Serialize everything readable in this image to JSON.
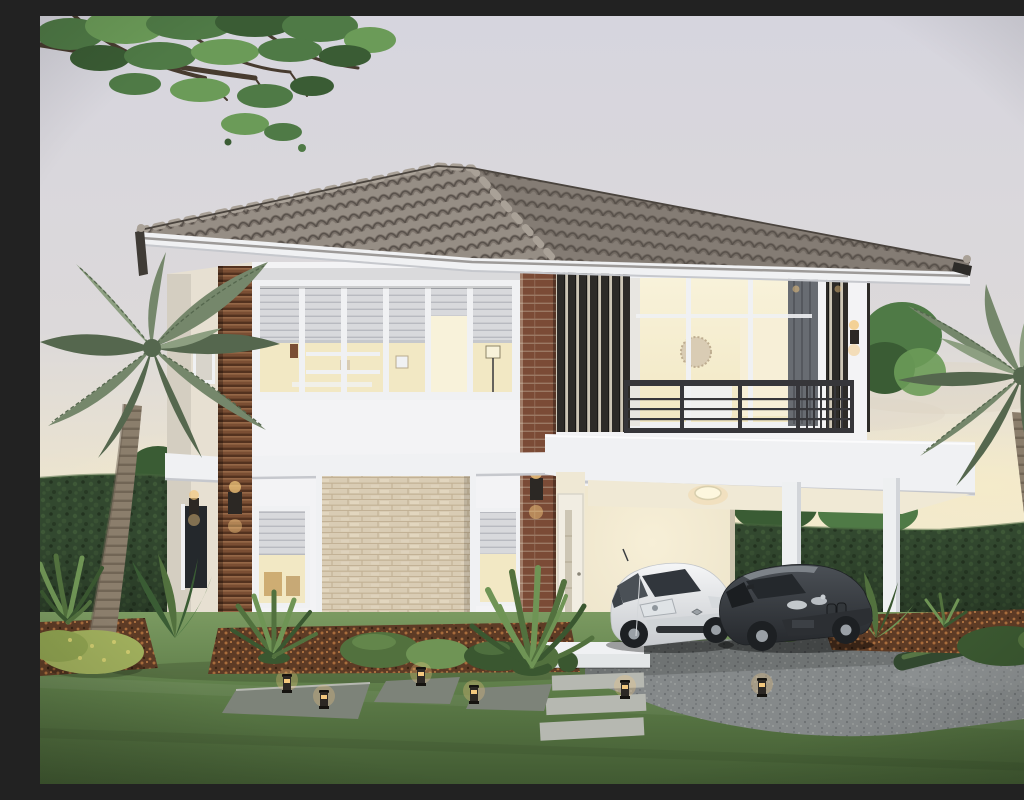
{
  "scene": {
    "label": "Architectural rendering of a two-story modern house at dusk with gray tile hip roof, wood-slat accents, lit interiors, balcony, carport with a white hatchback and a dark sedan, palm trees, perimeter hedge, lawn with stepping stones and garden bollard lights",
    "type": "exterior-architectural-rendering",
    "time_of_day": "dusk",
    "house": {
      "stories": 2,
      "roof": "gray-tile-hip-roof",
      "features": [
        "wrap-around-white-slab-band",
        "balcony-with-dark-railing",
        "vertical-louver-screens",
        "wood-slat-columns",
        "stone-feature-wall",
        "carport",
        "warm-interior-lighting",
        "wall-sconces",
        "roller-blinds"
      ]
    },
    "vehicles": [
      {
        "name": "white-hatchback"
      },
      {
        "name": "dark-gray-sedan"
      }
    ],
    "landscape": [
      "deciduous-tree-canopy",
      "left-palm-tree",
      "right-palm-tree",
      "perimeter-hedge",
      "lawn",
      "stepping-stones",
      "paver-path",
      "garden-bollard-lights",
      "shrub-beds-with-mulch",
      "spiky-accent-plants",
      "gravel-driveway"
    ],
    "garden_light_count": 6
  },
  "palette": {
    "sky_top": "#d6d5de",
    "sky_mid": "#dcd9da",
    "sky_warm": "#e9e2d1",
    "sky_horizon": "#f0e8d0",
    "glow": "#f6ecc9",
    "cloud": "#ddd5c4",
    "roof_light": "#968e85",
    "roof_mid": "#847c74",
    "roof_dark": "#655d56",
    "roof_line": "#57504a",
    "roof_ridge": "#a9a197",
    "roof_edge": "#4a443e",
    "fascia": "#f0f1f3",
    "fascia_shadow": "#c6c8cd",
    "soffit": "#e7e9ec",
    "wall": "#f3f3f5",
    "wall_bright": "#fbfbfc",
    "wall_shade": "#e3e1de",
    "wall_side": "#e7e0d2",
    "wall_side_dark": "#d8cfbd",
    "wall_cream": "#efe8d4",
    "wood_dark": "#53321f",
    "wood_mid": "#7a4e33",
    "wood_light": "#9a6b4a",
    "brick": "#7b4b36",
    "brick_line": "#a88d78",
    "louver": "#2d2b28",
    "louver_gap": "#cdc6b6",
    "glass_warm": "#f2e8c4",
    "glass_bright": "#f8f2da",
    "glass_dim": "#d8d4cb",
    "glass_dark": "#40454b",
    "glass_deep": "#24282c",
    "blind": "#d8d9dc",
    "blind_line": "#b8bac0",
    "rail": "#36363a",
    "stone": "#d9ccb4",
    "stone_line": "#bead90",
    "stone_hi": "#e7dcc7",
    "door": "#f1ede2",
    "door_glass": "#cdc6b4",
    "hedge": "#32482f",
    "hedge_light": "#4a673f",
    "hedge_deep": "#1f2e1d",
    "lawn_light": "#7b9a61",
    "lawn": "#5e7d49",
    "lawn_dark": "#415a32",
    "gravel": "#85898a",
    "gravel_dark": "#6b6f71",
    "gravel_dot": "#9c9f9e",
    "paver": "#7d8379",
    "paver_light": "#b6b8b1",
    "mulch": "#5d3b25",
    "mulch_dot": "#a86c3c",
    "shrub": "#52713e",
    "shrub_light": "#6f9455",
    "shrub_dark": "#3a5730",
    "shrub_yellow": "#9fae5c",
    "shrub_yellow_dot": "#cdc96e",
    "palm": "#75876b",
    "palm_dark": "#55674e",
    "palm_light": "#8d9f81",
    "trunk": "#8b7e6c",
    "trunk_dark": "#6c6051",
    "tree": "#4f7a46",
    "tree_light": "#6b9b58",
    "tree_dark": "#3a5c34",
    "branch": "#473b2f",
    "car_white": "#f5f6f7",
    "car_white_shade": "#c7cace",
    "car_dark": "#4b5056",
    "car_dark_deep": "#26292d",
    "car_glass": "#31363c",
    "wheel": "#1d2023",
    "hub": "#9aa0a6",
    "amber": "#f3c87e",
    "amber_deep": "#e2a44e",
    "lamp_box": "#2c2824",
    "column": "#eef0f1",
    "column_shade": "#d2d5d9",
    "ceiling": "#f0e9d5",
    "int_wall": "#ebe2c8",
    "int_wall_bright": "#f7efd7"
  }
}
